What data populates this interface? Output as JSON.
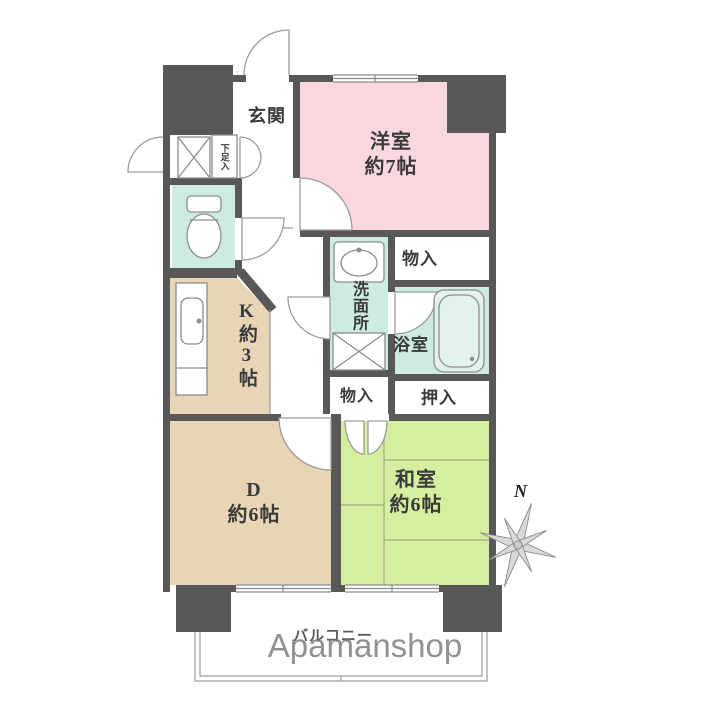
{
  "labels": {
    "genkan": "玄関",
    "gesokuire": "下足入",
    "yoshitsu_name": "洋室",
    "yoshitsu_size": "約7帖",
    "monoire_top": "物入",
    "senmenjo": "洗面所",
    "yokushitsu": "浴室",
    "oshiire": "押入",
    "monoire_hall": "物入",
    "kitchen": "K約3帖",
    "dining_name": "D",
    "dining_size": "約6帖",
    "washitsu_name": "和室",
    "washitsu_size": "約6帖",
    "balcony": "バルコニー",
    "compass_north": "N"
  },
  "watermark": "Apamanshop",
  "colors": {
    "western_room": "#f9d8e0",
    "japanese_room": "#d5ee9f",
    "kitchen_dining": "#e7d5b5",
    "sanitary": "#cdebe0",
    "wall": "#595757"
  }
}
